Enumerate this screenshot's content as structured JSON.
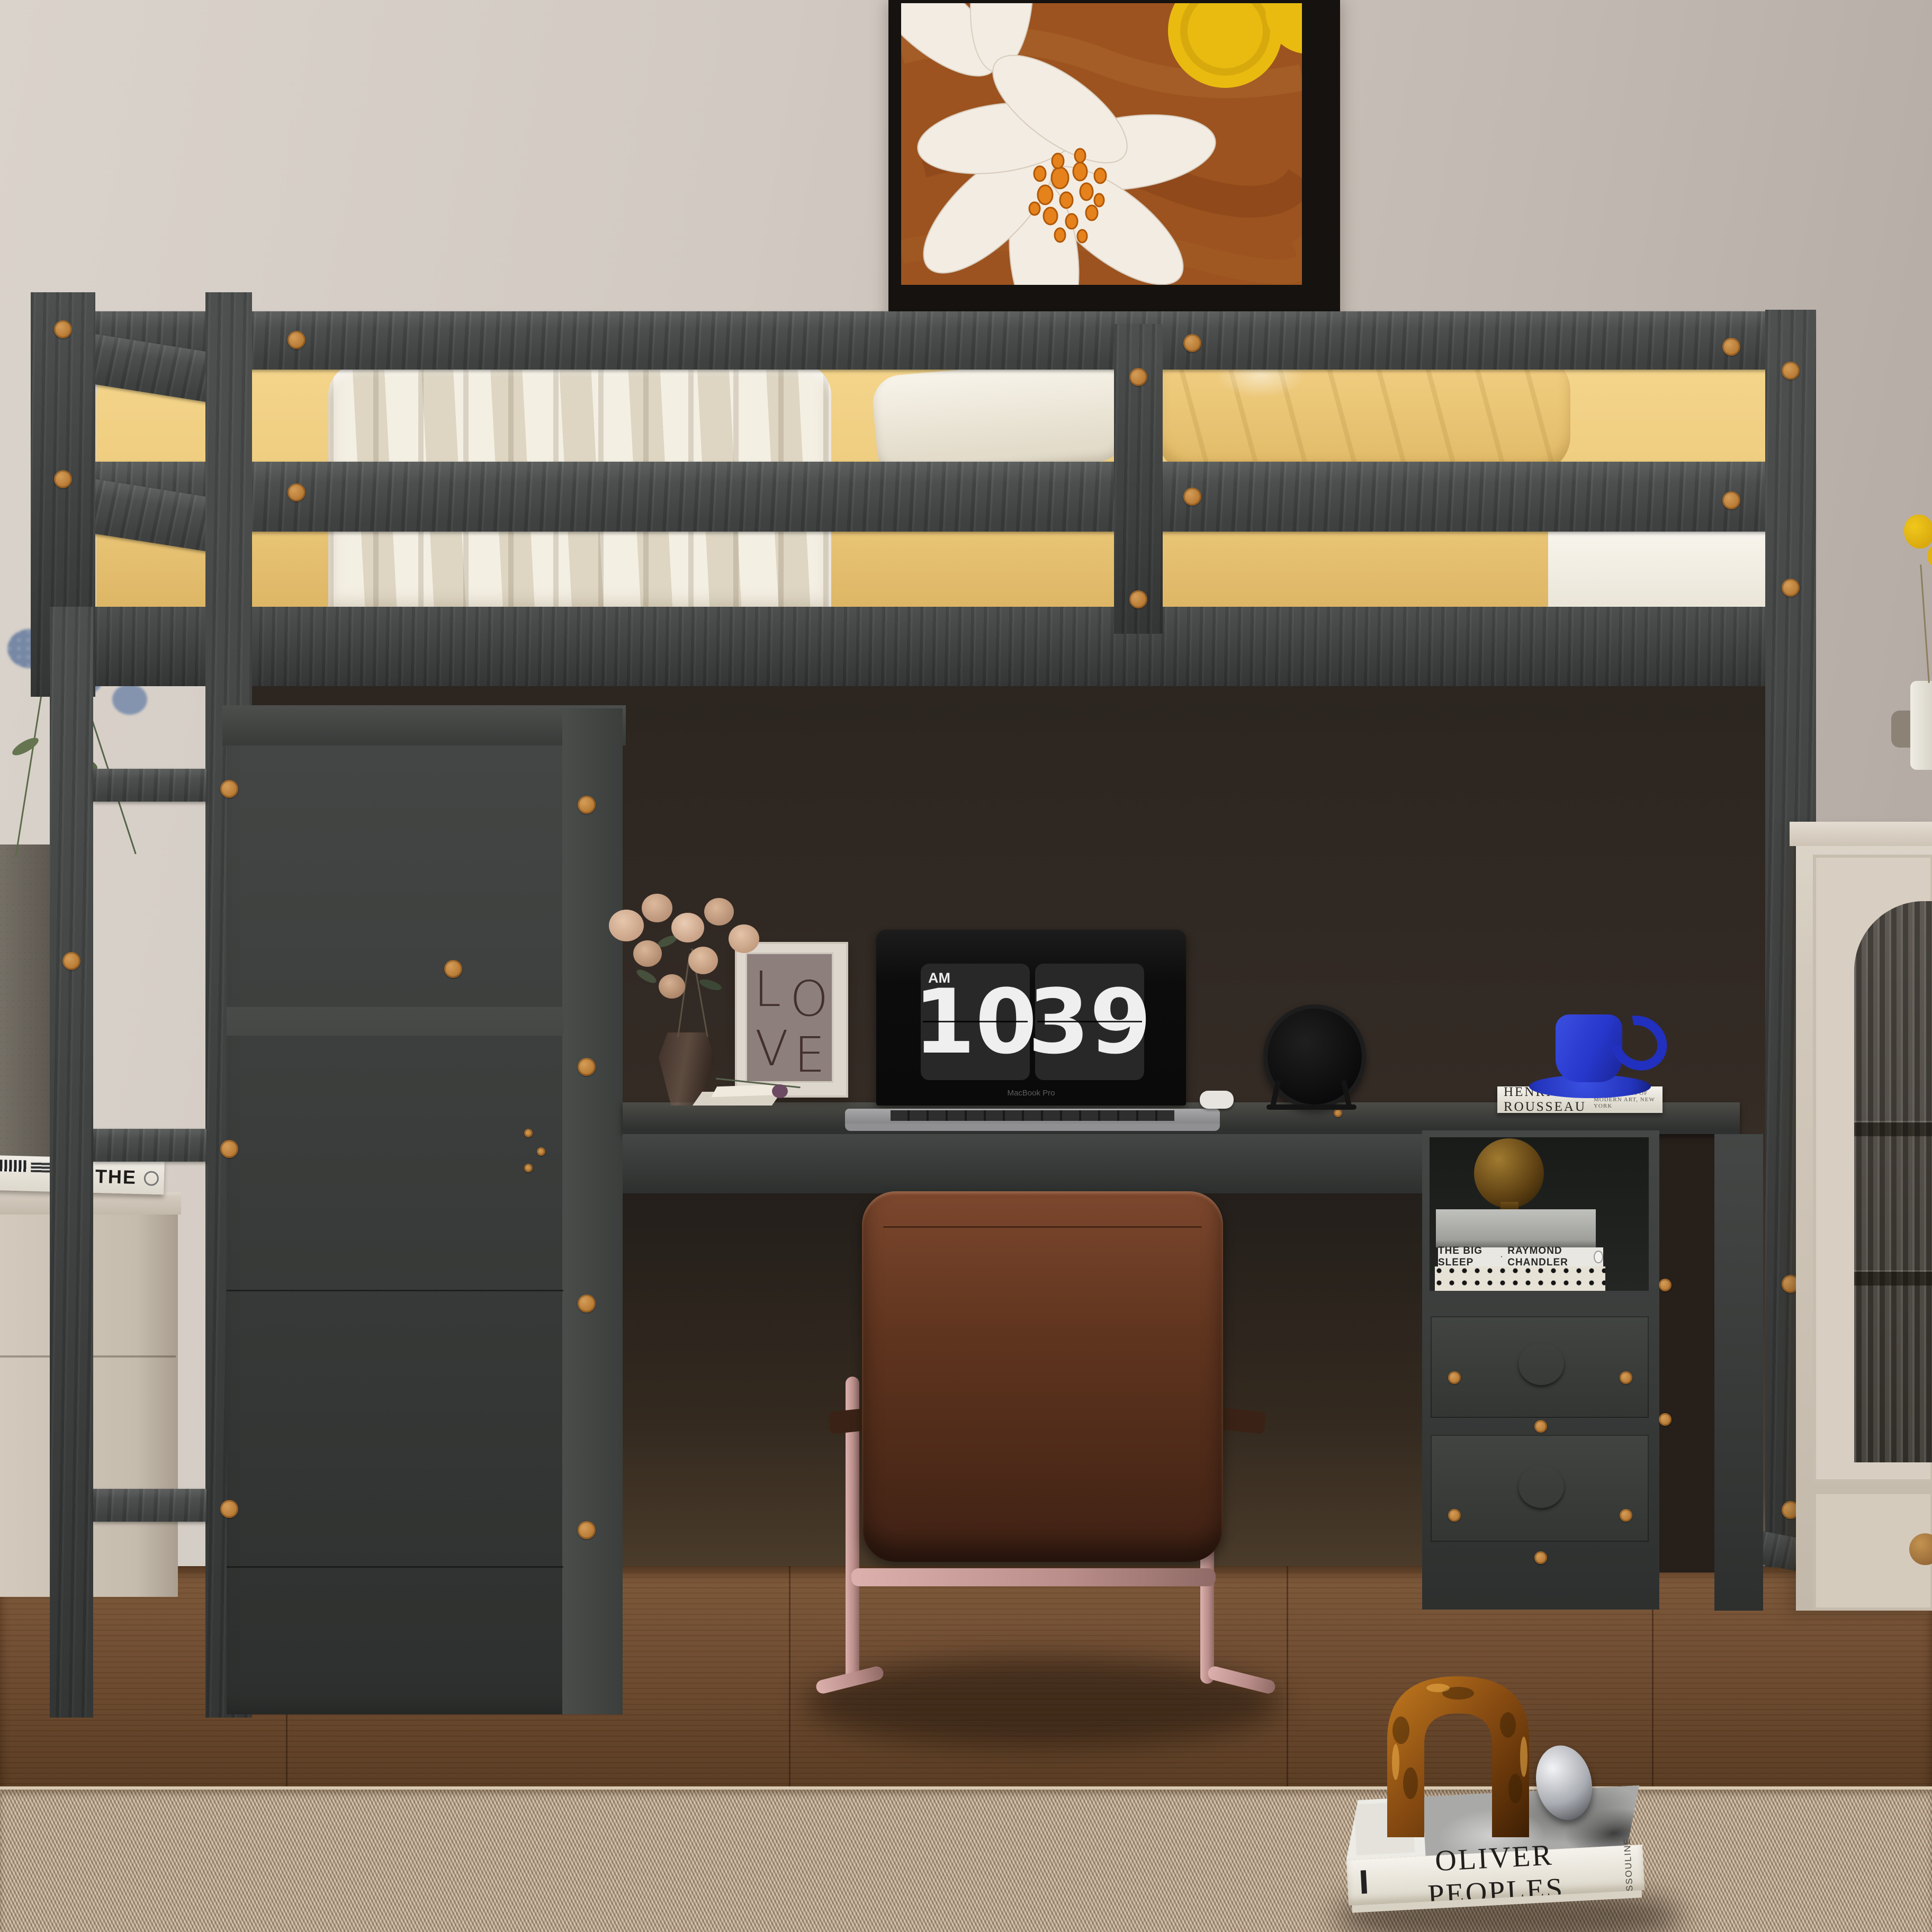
{
  "scene": {
    "description": "Product photo: gray wood loft bed with under-bed desk, wardrobe, ladder and drawers; office chair, laptop flip clock, decor in a beige bedroom",
    "time_display": {
      "meridiem": "AM",
      "hours": "10",
      "minutes": "39"
    }
  },
  "laptop": {
    "brand": "MacBook Pro"
  },
  "wall_frame": {
    "letters": {
      "l1": "L",
      "l2": "O",
      "l3": "V",
      "l4": "E"
    }
  },
  "books": {
    "desk_book": {
      "title": "HENRI ROUSSEAU",
      "subtitle": "THE MUSEUM OF MODERN ART, NEW YORK"
    },
    "shelf_book": {
      "title": "THE BIG SLEEP",
      "separator": "·",
      "author": "RAYMOND CHANDLER"
    },
    "floor_book": {
      "title": "OLIVER PEOPLES",
      "publisher": "ASSOULINE"
    },
    "side_table_book": {
      "title": "THE"
    }
  },
  "colors": {
    "wall": "#cfc7bf",
    "shadow": "#2e2823",
    "floor-wood": "#6b4a31",
    "rug": "#c4b29c",
    "bed-wood": "#4c4f4e",
    "bed-wood-dark": "#424544",
    "peg": "#b97c36",
    "mattress": "#eecb7d",
    "bedding-white": "#efe9da",
    "desk-wood": "#3a3d3b",
    "knob": "#2b2e2c",
    "chair-leather": "#5f3520",
    "chair-frame": "#b98d89",
    "cream": "#d2c9bc",
    "mug-blue": "#2738cd",
    "clock-card": "#282828",
    "clock-digit": "#efefef",
    "painting-rust": "#9c531f",
    "painting-petal": "#f3ece2",
    "painting-dot": "#e5821c",
    "painting-yellow": "#e9bb10"
  }
}
